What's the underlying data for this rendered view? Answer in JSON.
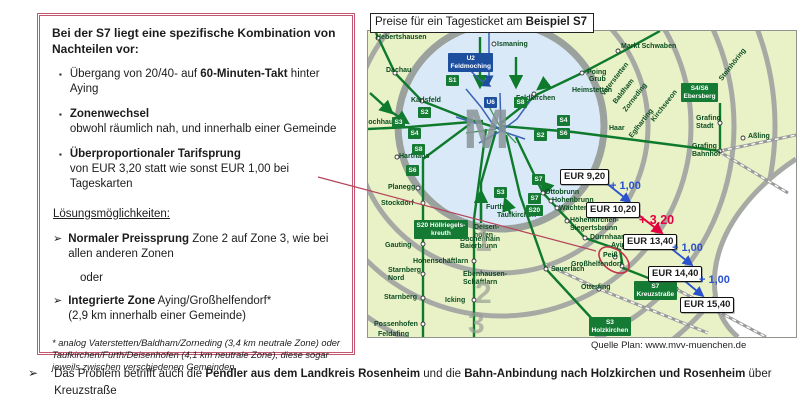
{
  "problem_box": {
    "title": "Bei der S7 liegt eine spezifische Kombination von Nachteilen vor:",
    "bullet_marker": "▪",
    "arrow_marker": "➢",
    "bullets": [
      {
        "pre": "Übergang von 20/40- auf ",
        "bold": "60-Minuten-Takt",
        "post": " hinter Aying"
      },
      {
        "bold": "Zonenwechsel",
        "sub": "obwohl räumlich nah, und innerhalb einer Gemeinde"
      },
      {
        "bold": "Überproportionaler Tarifsprung",
        "sub": "von EUR 3,20 statt wie sonst EUR 1,00 bei Tageskarten"
      }
    ],
    "solutions_heading": "Lösungsmöglichkeiten:",
    "solution1": {
      "bold": "Normaler Preissprung",
      "post": " Zone 2 auf Zone 3, wie bei allen anderen Zonen"
    },
    "or_label": "oder",
    "solution2": {
      "bold": "Integrierte Zone",
      "post": " Aying/Großhelfendorf*",
      "sub": "(2,9 km innerhalb einer Gemeinde)"
    },
    "footnote": "* analog Vaterstetten/Baldham/Zorneding (3,4 km neutrale Zone) oder Taufkirchen/Furth/Deisenhofen (4,1 km neutrale Zone), diese sogar jeweils zwischen verschiedenen Gemeinden"
  },
  "map": {
    "title": {
      "pre": "Preise für ein Tagesticket am ",
      "bold": "Beispiel S7"
    },
    "source": "Quelle Plan: www.mvv-muenchen.de",
    "center_label": "M",
    "zone_numbers": [
      {
        "t": "1",
        "x": 107,
        "y": 196
      },
      {
        "t": "2",
        "x": 107,
        "y": 248
      },
      {
        "t": "3",
        "x": 100,
        "y": 278
      }
    ],
    "prices": [
      {
        "label": "EUR 9,20",
        "x": 192,
        "y": 138
      },
      {
        "label": "EUR 10,20",
        "x": 218,
        "y": 171
      },
      {
        "label": "EUR 13,40",
        "x": 255,
        "y": 203
      },
      {
        "label": "EUR 14,40",
        "x": 280,
        "y": 235
      },
      {
        "label": "EUR 15,40",
        "x": 312,
        "y": 266
      }
    ],
    "increments": [
      {
        "label": "+ 1,00",
        "x": 242,
        "y": 150,
        "color": "#2a52cc",
        "big": false
      },
      {
        "label": "+ 3,20",
        "x": 271,
        "y": 183,
        "color": "#e3003f",
        "big": true
      },
      {
        "label": "+ 1,00",
        "x": 304,
        "y": 212,
        "color": "#2a52cc",
        "big": false
      },
      {
        "label": "+ 1,00",
        "x": 331,
        "y": 244,
        "color": "#2a52cc",
        "big": false
      }
    ],
    "badges": [
      {
        "t": "U2\nFeldmoching",
        "x": 80,
        "y": 22,
        "u": true
      },
      {
        "t": "U6",
        "x": 116,
        "y": 66,
        "u": true
      },
      {
        "t": "S1",
        "x": 78,
        "y": 44
      },
      {
        "t": "S8",
        "x": 146,
        "y": 66
      },
      {
        "t": "S2",
        "x": 50,
        "y": 76
      },
      {
        "t": "S3",
        "x": 24,
        "y": 86
      },
      {
        "t": "S4",
        "x": 40,
        "y": 97
      },
      {
        "t": "S8",
        "x": 44,
        "y": 113
      },
      {
        "t": "S6",
        "x": 38,
        "y": 134
      },
      {
        "t": "S2",
        "x": 166,
        "y": 99
      },
      {
        "t": "S4",
        "x": 189,
        "y": 84
      },
      {
        "t": "S6",
        "x": 189,
        "y": 97
      },
      {
        "t": "S7",
        "x": 164,
        "y": 143
      },
      {
        "t": "S3",
        "x": 126,
        "y": 156
      },
      {
        "t": "S7",
        "x": 160,
        "y": 162
      },
      {
        "t": "S20",
        "x": 158,
        "y": 174
      },
      {
        "t": "S4/S6\nEbersberg",
        "x": 313,
        "y": 52
      },
      {
        "t": "S20 Höllriegels-\nkreuth",
        "x": 46,
        "y": 189
      },
      {
        "t": "S7\nKreuzstraße",
        "x": 266,
        "y": 250
      },
      {
        "t": "S3\nHolzkirchen",
        "x": 221,
        "y": 286
      }
    ],
    "stations": [
      {
        "t": "Hebertshausen",
        "x": 8,
        "y": 3
      },
      {
        "t": "Dachau",
        "x": 18,
        "y": 36
      },
      {
        "t": "Karlsfeld",
        "x": 43,
        "y": 66
      },
      {
        "t": "Lochhausen",
        "x": -4,
        "y": 88
      },
      {
        "t": "Harthaus",
        "x": 31,
        "y": 122
      },
      {
        "t": "Planegg",
        "x": 20,
        "y": 153
      },
      {
        "t": "Stockdorf",
        "x": 13,
        "y": 169
      },
      {
        "t": "Gauting",
        "x": 17,
        "y": 211
      },
      {
        "t": "Hohenschäftlarn",
        "x": 45,
        "y": 227
      },
      {
        "t": "Starnberg\nNord",
        "x": 20,
        "y": 236
      },
      {
        "t": "Starnberg",
        "x": 16,
        "y": 263
      },
      {
        "t": "Possenhofen",
        "x": 6,
        "y": 290
      },
      {
        "t": "Feldafing",
        "x": 10,
        "y": 300
      },
      {
        "t": "Buchenhain",
        "x": 92,
        "y": 205
      },
      {
        "t": "Baierbrunn",
        "x": 92,
        "y": 212
      },
      {
        "t": "Ebenhausen-\nSchäftlarn",
        "x": 95,
        "y": 240
      },
      {
        "t": "Icking",
        "x": 77,
        "y": 266
      },
      {
        "t": "Furth",
        "x": 118,
        "y": 173
      },
      {
        "t": "Taufkirchen",
        "x": 129,
        "y": 181
      },
      {
        "t": "Deisen-\nhofen",
        "x": 106,
        "y": 193
      },
      {
        "t": "Sauerlach",
        "x": 183,
        "y": 235
      },
      {
        "t": "Otterfing",
        "x": 213,
        "y": 253
      },
      {
        "t": "Ismaning",
        "x": 129,
        "y": 10
      },
      {
        "t": "Feldkirchen",
        "x": 148,
        "y": 64
      },
      {
        "t": "Heimstetten",
        "x": 204,
        "y": 56
      },
      {
        "t": "Grub",
        "x": 221,
        "y": 45
      },
      {
        "t": "Poing",
        "x": 219,
        "y": 38
      },
      {
        "t": "Markt Schwaben",
        "x": 253,
        "y": 12
      },
      {
        "t": "Haar",
        "x": 241,
        "y": 94
      },
      {
        "t": "Vaterstetten",
        "x": 232,
        "y": 62,
        "r": -52
      },
      {
        "t": "Baldham",
        "x": 244,
        "y": 70,
        "r": -52
      },
      {
        "t": "Zorneding",
        "x": 254,
        "y": 78,
        "r": -52
      },
      {
        "t": "Kirchseeon",
        "x": 282,
        "y": 88,
        "r": -52
      },
      {
        "t": "Eglharting",
        "x": 260,
        "y": 104,
        "r": -52
      },
      {
        "t": "Steinhöring",
        "x": 350,
        "y": 47,
        "r": -52
      },
      {
        "t": "Grafing\nStadt",
        "x": 328,
        "y": 84
      },
      {
        "t": "Grafing\nBahnhof",
        "x": 324,
        "y": 112
      },
      {
        "t": "Aßling",
        "x": 380,
        "y": 102
      },
      {
        "t": "Ottobrunn",
        "x": 177,
        "y": 158
      },
      {
        "t": "Hohenbrunn",
        "x": 184,
        "y": 166
      },
      {
        "t": "Wächterhof",
        "x": 191,
        "y": 174
      },
      {
        "t": "Höhenkirchen-\nSiegertsbrunn",
        "x": 202,
        "y": 186
      },
      {
        "t": "Dürrnhaar",
        "x": 222,
        "y": 203
      },
      {
        "t": "Aying",
        "x": 243,
        "y": 211
      },
      {
        "t": "Peiß",
        "x": 235,
        "y": 221
      },
      {
        "t": "Großhelfendorf",
        "x": 203,
        "y": 230
      }
    ]
  },
  "footer": {
    "pre": "Das Problem betrifft auch die ",
    "bold1": "Pendler aus dem Landkreis Rosenheim",
    "mid": " und die ",
    "bold2": "Bahn-Anbindung nach Holzkirchen und Rosenheim",
    "post": " über Kreuzstraße"
  },
  "colors": {
    "box_border": "#c2566f",
    "sbahn_green": "#157a33",
    "ubahn_blue": "#1d4f9e",
    "increment_blue": "#2a52cc",
    "increment_red": "#e3003f",
    "map_background": "#e9f1c6",
    "inner_zone_blue": "#d9e9f7",
    "ring_gray": "#a6a9a4"
  }
}
